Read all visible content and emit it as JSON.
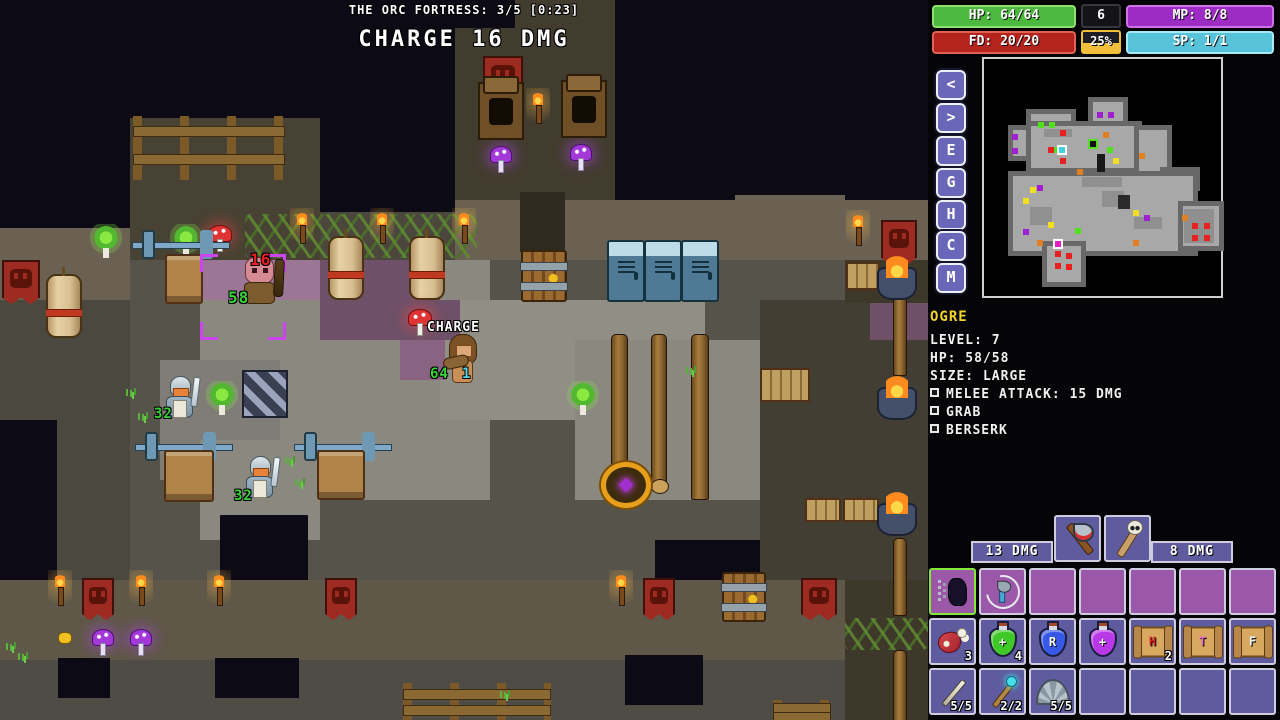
{
  "hud": {
    "location_label": "THE ORC FORTRESS: 3/5 [0:23]",
    "action_label": "CHARGE 16 DMG",
    "bars": [
      {
        "id": "hp",
        "label": "HP: 64/64",
        "fill": "#4db83e",
        "edge": "#8fe070",
        "x": 932,
        "y": 5,
        "w": 144
      },
      {
        "id": "fd",
        "label": "FD: 20/20",
        "fill": "#b5231f",
        "edge": "#e0614f",
        "x": 932,
        "y": 31,
        "w": 144
      },
      {
        "id": "mp",
        "label": "MP: 8/8",
        "fill": "#9d2cc4",
        "edge": "#cf72ea",
        "x": 1126,
        "y": 5,
        "w": 148
      },
      {
        "id": "sp",
        "label": "SP: 1/1",
        "fill": "#56c3da",
        "edge": "#a9ebf5",
        "x": 1126,
        "y": 31,
        "w": 148
      }
    ],
    "level": {
      "value": "6",
      "xp": "25%",
      "xp_color": "#f2bf3a"
    },
    "nav_buttons": [
      "<",
      ">",
      "E",
      "G",
      "H",
      "C",
      "M"
    ],
    "nav_y": [
      70,
      103,
      136,
      168,
      200,
      231,
      263
    ],
    "monster": {
      "name": "OGRE",
      "stats": [
        "LEVEL: 7",
        "HP: 58/58",
        "SIZE: LARGE"
      ],
      "abilities": [
        "MELEE ATTACK: 15 DMG",
        "GRAB",
        "BERSERK"
      ]
    },
    "weapons": {
      "left_label": "13 DMG",
      "right_label": "8 DMG",
      "slots": [
        {
          "icon": "axe",
          "name": "axe-weapon"
        },
        {
          "icon": "club",
          "name": "skull-club-weapon"
        }
      ]
    },
    "ability_slots": [
      {
        "icon": "charge",
        "name": "charge-ability",
        "selected": true
      },
      {
        "icon": "throwaxe",
        "name": "throw-axe-ability"
      },
      null,
      null,
      null,
      null,
      null
    ],
    "item_rows": [
      [
        {
          "icon": "meat",
          "name": "meat-item",
          "count": "3"
        },
        {
          "icon": "potion",
          "name": "healing-potion",
          "color": "#40c828",
          "glyph": "+",
          "glyph_color": "#fff"
        },
        {
          "icon": "potion",
          "name": "r-potion",
          "color": "#3858e8",
          "glyph": "R",
          "glyph_color": "#fff",
          "count": ""
        },
        {
          "icon": "potion",
          "name": "magic-potion",
          "color": "#b838e8",
          "glyph": "+",
          "glyph_color": "#fff"
        },
        {
          "icon": "scroll",
          "name": "scroll-h",
          "glyph": "H",
          "glyph_color": "#d82020",
          "count": "2"
        },
        {
          "icon": "scroll",
          "name": "scroll-t",
          "glyph": "T",
          "glyph_color": "#e868c8"
        },
        {
          "icon": "scroll",
          "name": "scroll-f",
          "glyph": "F",
          "glyph_color": "#f0f0f0"
        }
      ],
      [
        {
          "icon": "wand",
          "name": "wand-item",
          "count": "5/5"
        },
        {
          "icon": "staffw",
          "name": "staff-item",
          "count": "2/2"
        },
        {
          "icon": "shell",
          "name": "shell-item",
          "count": "5/5"
        },
        null,
        null,
        null,
        null
      ]
    ],
    "potion_count_4": "4"
  },
  "minimap": {
    "rooms": [
      [
        104,
        38,
        40,
        36
      ],
      [
        42,
        50,
        50,
        36
      ],
      [
        24,
        66,
        24,
        36
      ],
      [
        42,
        62,
        116,
        52
      ],
      [
        150,
        66,
        38,
        54
      ],
      [
        176,
        108,
        40,
        24
      ],
      [
        24,
        112,
        190,
        85
      ],
      [
        58,
        182,
        44,
        46
      ],
      [
        194,
        142,
        46,
        50
      ]
    ],
    "patches": [
      [
        60,
        70,
        28,
        8,
        "#909090"
      ],
      [
        98,
        118,
        40,
        10,
        "#909090"
      ],
      [
        150,
        158,
        28,
        12,
        "#909090"
      ],
      [
        46,
        148,
        22,
        18,
        "#909090"
      ],
      [
        118,
        132,
        22,
        16,
        "#909090"
      ],
      [
        134,
        136,
        12,
        14,
        "#2a2a2a"
      ],
      [
        113,
        95,
        8,
        18,
        "#181818"
      ],
      [
        200,
        150,
        30,
        34,
        "#8f8f8f"
      ]
    ],
    "dots": [
      [
        113,
        53,
        "#a020d0"
      ],
      [
        124,
        53,
        "#a020d0"
      ],
      [
        28,
        75,
        "#a020d0"
      ],
      [
        28,
        89,
        "#a020d0"
      ],
      [
        53,
        126,
        "#a020d0"
      ],
      [
        39,
        170,
        "#a020d0"
      ],
      [
        160,
        156,
        "#a020d0"
      ],
      [
        54,
        63,
        "#50e020"
      ],
      [
        65,
        63,
        "#50e020"
      ],
      [
        68,
        88,
        "#50e020"
      ],
      [
        123,
        88,
        "#50e020"
      ],
      [
        91,
        169,
        "#50e020"
      ],
      [
        76,
        71,
        "#e82020"
      ],
      [
        64,
        88,
        "#e82020"
      ],
      [
        76,
        99,
        "#e82020"
      ],
      [
        71,
        192,
        "#e82020"
      ],
      [
        82,
        194,
        "#e82020"
      ],
      [
        71,
        204,
        "#e82020"
      ],
      [
        82,
        205,
        "#e82020"
      ],
      [
        208,
        164,
        "#e82020"
      ],
      [
        220,
        164,
        "#e82020"
      ],
      [
        208,
        176,
        "#e82020"
      ],
      [
        220,
        176,
        "#e82020"
      ],
      [
        129,
        99,
        "#f0e020"
      ],
      [
        46,
        128,
        "#f0e020"
      ],
      [
        39,
        139,
        "#f0e020"
      ],
      [
        64,
        163,
        "#f0e020"
      ],
      [
        149,
        151,
        "#f0e020"
      ],
      [
        119,
        73,
        "#e08020"
      ],
      [
        155,
        94,
        "#e08020"
      ],
      [
        53,
        181,
        "#e08020"
      ],
      [
        149,
        181,
        "#e08020"
      ],
      [
        198,
        156,
        "#e08020"
      ],
      [
        93,
        110,
        "#e08020"
      ]
    ],
    "special_dots": [
      {
        "x": 75,
        "y": 88,
        "c": "#40d0e0",
        "b": "#ffffff",
        "name": "minimap-player-dot"
      },
      {
        "x": 106,
        "y": 82,
        "c": "#101010",
        "b": "#50e020",
        "name": "minimap-target-dot"
      },
      {
        "x": 71,
        "y": 182,
        "c": "#e020c0",
        "b": "#ffffff",
        "name": "minimap-item-dot"
      }
    ]
  },
  "map": {
    "regions": [
      [
        130,
        118,
        190,
        142,
        "#474233",
        "bricks"
      ],
      [
        320,
        212,
        170,
        48,
        "#4b473c",
        "bricks"
      ],
      [
        515,
        0,
        100,
        30,
        "#423c2e",
        "bricks"
      ],
      [
        455,
        28,
        160,
        190,
        "#423c2e",
        "bricks"
      ],
      [
        455,
        200,
        473,
        60,
        "#6b6152",
        "bricks"
      ],
      [
        735,
        195,
        110,
        105,
        "#6b6152",
        "bricks"
      ],
      [
        520,
        192,
        45,
        60,
        "#2e2a20",
        "bricks"
      ],
      [
        0,
        228,
        130,
        72,
        "#6b6152",
        "bricks"
      ],
      [
        130,
        260,
        715,
        320,
        "#56534a",
        "tiles"
      ],
      [
        0,
        300,
        130,
        280,
        "#4b4840",
        "tiles"
      ],
      [
        760,
        300,
        168,
        280,
        "#433e33",
        "tiles"
      ],
      [
        200,
        260,
        290,
        240,
        "#8b8880",
        "tiles"
      ],
      [
        440,
        300,
        265,
        120,
        "#918e86",
        "tiles"
      ],
      [
        575,
        340,
        185,
        160,
        "#8b8880",
        "tiles"
      ],
      [
        160,
        360,
        120,
        120,
        "#807d76",
        "tiles"
      ],
      [
        200,
        440,
        120,
        100,
        "#8b8880",
        "tiles"
      ],
      [
        200,
        260,
        120,
        40,
        "#9c7795",
        "tiles"
      ],
      [
        320,
        260,
        120,
        40,
        "#6e5168",
        "tiles"
      ],
      [
        320,
        300,
        140,
        40,
        "#6e5168",
        "tiles"
      ],
      [
        400,
        340,
        45,
        40,
        "#8a6383",
        "tiles"
      ],
      [
        870,
        303,
        58,
        37,
        "#6e5168",
        "tiles"
      ],
      [
        0,
        420,
        57,
        160,
        "#0c0a14",
        "plain"
      ],
      [
        220,
        515,
        88,
        65,
        "#0c0a14",
        "plain"
      ],
      [
        655,
        540,
        105,
        40,
        "#0c0a14",
        "plain"
      ],
      [
        0,
        580,
        845,
        80,
        "#5f5747",
        "bricks"
      ],
      [
        0,
        660,
        928,
        60,
        "#4f4c45",
        "tiles"
      ],
      [
        845,
        260,
        83,
        43,
        "#3e382b",
        "bricks"
      ],
      [
        845,
        580,
        83,
        140,
        "#3e382b",
        "tiles"
      ],
      [
        58,
        658,
        52,
        40,
        "#0c0a14",
        "plain"
      ],
      [
        215,
        658,
        84,
        40,
        "#0c0a14",
        "plain"
      ],
      [
        625,
        655,
        78,
        50,
        "#0c0a14",
        "plain"
      ]
    ],
    "sprites": [
      [
        "fence",
        133,
        116,
        152,
        64
      ],
      [
        "fence",
        403,
        683,
        148,
        37
      ],
      [
        "fence",
        773,
        700,
        58,
        20
      ],
      [
        "vine",
        245,
        214,
        232,
        44
      ],
      [
        "vine",
        845,
        618,
        83,
        32
      ],
      [
        "banner",
        2,
        260,
        34,
        44
      ],
      [
        "banner",
        483,
        56,
        36,
        46
      ],
      [
        "banner",
        881,
        220,
        32,
        44
      ],
      [
        "banner",
        82,
        578,
        28,
        42
      ],
      [
        "banner",
        325,
        578,
        28,
        42
      ],
      [
        "banner",
        643,
        578,
        28,
        42
      ],
      [
        "banner",
        801,
        578,
        32,
        42
      ],
      [
        "torch",
        290,
        208,
        24,
        42
      ],
      [
        "torch",
        370,
        208,
        24,
        42
      ],
      [
        "torch",
        452,
        208,
        24,
        42
      ],
      [
        "torch",
        846,
        210,
        24,
        42
      ],
      [
        "torch",
        526,
        88,
        24,
        42
      ],
      [
        "torch",
        48,
        570,
        24,
        42
      ],
      [
        "torch",
        129,
        570,
        24,
        42
      ],
      [
        "torch",
        207,
        570,
        24,
        42
      ],
      [
        "torch",
        609,
        570,
        24,
        42
      ],
      [
        "bag",
        46,
        274,
        32,
        60
      ],
      [
        "bag",
        328,
        236,
        32,
        60
      ],
      [
        "bag",
        409,
        236,
        32,
        60
      ],
      [
        "locker",
        607,
        240,
        34,
        58
      ],
      [
        "locker",
        644,
        240,
        34,
        58
      ],
      [
        "locker",
        681,
        240,
        34,
        58
      ],
      [
        "door",
        521,
        250,
        42,
        48
      ],
      [
        "door",
        722,
        572,
        40,
        46
      ],
      [
        "tree",
        88,
        224,
        36,
        36
      ],
      [
        "tree",
        168,
        224,
        36,
        36
      ],
      [
        "tree",
        204,
        381,
        36,
        36
      ],
      [
        "tree",
        565,
        381,
        36,
        36
      ],
      [
        "mushroom",
        204,
        220,
        30,
        34
      ],
      [
        "mushroom",
        404,
        304,
        30,
        34
      ],
      [
        "mushroomp",
        486,
        141,
        28,
        34
      ],
      [
        "mushroomp",
        566,
        139,
        28,
        34
      ],
      [
        "mushroomp",
        88,
        624,
        28,
        34
      ],
      [
        "mushroomp",
        126,
        624,
        28,
        34
      ],
      [
        "throne",
        478,
        82,
        42,
        54
      ],
      [
        "throne",
        561,
        80,
        42,
        54
      ],
      [
        "barbell",
        132,
        228,
        98,
        30
      ],
      [
        "barbell",
        135,
        430,
        98,
        30
      ],
      [
        "barbell",
        294,
        430,
        98,
        30
      ],
      [
        "bench",
        165,
        254,
        34,
        46
      ],
      [
        "bench",
        164,
        450,
        46,
        48
      ],
      [
        "bench",
        317,
        450,
        44,
        46
      ],
      [
        "rack",
        760,
        368,
        46,
        30
      ],
      [
        "rack",
        805,
        498,
        32,
        20
      ],
      [
        "rack",
        843,
        498,
        32,
        20
      ],
      [
        "rack",
        846,
        262,
        30,
        24
      ],
      [
        "stairs",
        242,
        370,
        42,
        44
      ],
      [
        "pole",
        611,
        334,
        15,
        162
      ],
      [
        "pole2",
        651,
        334,
        14,
        148
      ],
      [
        "pole",
        691,
        334,
        16,
        164
      ],
      [
        "pole",
        893,
        296,
        12,
        78
      ],
      [
        "pole",
        893,
        538,
        12,
        76
      ],
      [
        "pole",
        893,
        650,
        12,
        70
      ],
      [
        "basket",
        601,
        462,
        40,
        36
      ],
      [
        "cauldron",
        874,
        250,
        46,
        50
      ],
      [
        "cauldron",
        874,
        370,
        46,
        50
      ],
      [
        "cauldron",
        874,
        486,
        46,
        50
      ],
      [
        "grass",
        126,
        386,
        12,
        10
      ],
      [
        "grass",
        138,
        410,
        12,
        10
      ],
      [
        "grass",
        285,
        454,
        12,
        10
      ],
      [
        "grass",
        295,
        476,
        12,
        10
      ],
      [
        "grass",
        686,
        364,
        12,
        10
      ],
      [
        "grass",
        6,
        640,
        12,
        10
      ],
      [
        "grass",
        18,
        650,
        12,
        10
      ],
      [
        "grass",
        500,
        688,
        12,
        10
      ],
      [
        "gold",
        58,
        632,
        12,
        10
      ],
      [
        "selection",
        200,
        254,
        86,
        86
      ],
      [
        "ogre",
        238,
        256,
        46,
        48
      ],
      [
        "knight",
        162,
        376,
        35,
        42
      ],
      [
        "knight",
        242,
        456,
        35,
        42
      ],
      [
        "player",
        442,
        334,
        42,
        50
      ]
    ],
    "labels": [
      [
        "16",
        250,
        250,
        "#e82020",
        16
      ],
      [
        "58",
        228,
        288,
        "#35d435",
        16
      ],
      [
        "32",
        154,
        406,
        "#35d435",
        14
      ],
      [
        "32",
        234,
        488,
        "#35d435",
        14
      ],
      [
        "CHARGE",
        427,
        320,
        "#ffffff",
        13
      ],
      [
        "64",
        430,
        366,
        "#35d435",
        14
      ],
      [
        "1",
        462,
        366,
        "#52d8e8",
        14
      ]
    ]
  }
}
